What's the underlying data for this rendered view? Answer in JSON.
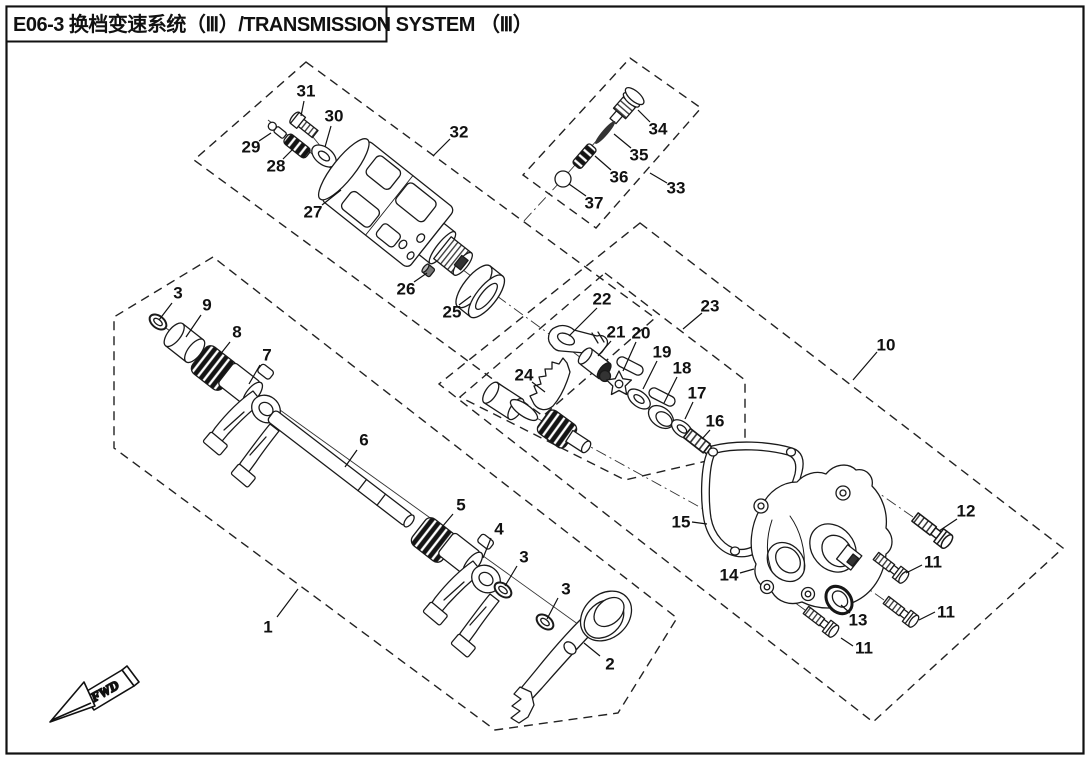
{
  "title": {
    "text": "E06-3 换档变速系统（Ⅲ）/TRANSMISSION SYSTEM （Ⅲ）"
  },
  "fwd": {
    "label": "FWD"
  },
  "colors": {
    "ink": "#1a1a1a",
    "paper": "#ffffff"
  },
  "groups": [
    {
      "id": "shift-fork-shaft-assembly",
      "label_num": "1",
      "points": "213,257 114,317 114,448 495,730 618,713 677,618"
    },
    {
      "id": "shift-drum-assembly",
      "label_num": "32",
      "points": "306,62 655,318 543,416 194,160"
    },
    {
      "id": "detent-assembly",
      "label_num": "33",
      "points": "630,58 701,108 596,228 523,175"
    },
    {
      "id": "shift-cam-assembly",
      "label_num": "23",
      "points": "605,273 745,380 745,452 625,480 460,397"
    },
    {
      "id": "cover-assembly",
      "label_num": "10",
      "points": "640,223 1063,548 873,722 439,384"
    }
  ],
  "centerlines": [
    {
      "x1": 152,
      "y1": 318,
      "x2": 600,
      "y2": 640,
      "style": "solid"
    },
    {
      "x1": 268,
      "y1": 120,
      "x2": 497,
      "y2": 296,
      "style": "solid"
    },
    {
      "x1": 303,
      "y1": 125,
      "x2": 322,
      "y2": 148,
      "style": "solid"
    },
    {
      "x1": 636,
      "y1": 96,
      "x2": 560,
      "y2": 182,
      "style": "solid"
    },
    {
      "x1": 552,
      "y1": 336,
      "x2": 726,
      "y2": 468,
      "style": "solid"
    },
    {
      "x1": 497,
      "y1": 397,
      "x2": 578,
      "y2": 440,
      "style": "solid"
    },
    {
      "x1": 497,
      "y1": 296,
      "x2": 556,
      "y2": 339,
      "style": "dashdot"
    },
    {
      "x1": 560,
      "y1": 182,
      "x2": 523,
      "y2": 222,
      "style": "dashdot"
    },
    {
      "x1": 578,
      "y1": 440,
      "x2": 716,
      "y2": 516,
      "style": "dashdot"
    },
    {
      "x1": 872,
      "y1": 556,
      "x2": 840,
      "y2": 532,
      "style": "dashdot"
    },
    {
      "x1": 884,
      "y1": 600,
      "x2": 850,
      "y2": 576,
      "style": "dashdot"
    },
    {
      "x1": 805,
      "y1": 610,
      "x2": 772,
      "y2": 586,
      "style": "dashdot"
    },
    {
      "x1": 913,
      "y1": 517,
      "x2": 880,
      "y2": 494,
      "style": "dashdot"
    }
  ],
  "part_labels": [
    {
      "num": "1",
      "x": 268,
      "y": 627,
      "leader": [
        277,
        617,
        298,
        589
      ]
    },
    {
      "num": "2",
      "x": 610,
      "y": 664,
      "leader": [
        600,
        656,
        584,
        643
      ]
    },
    {
      "num": "3",
      "x": 178,
      "y": 293,
      "leader": [
        172,
        303,
        159,
        320
      ]
    },
    {
      "num": "9",
      "x": 207,
      "y": 305,
      "leader": [
        201,
        315,
        186,
        337
      ]
    },
    {
      "num": "8",
      "x": 237,
      "y": 332,
      "leader": [
        230,
        342,
        215,
        361
      ]
    },
    {
      "num": "7",
      "x": 267,
      "y": 355,
      "leader": [
        260,
        365,
        249,
        384
      ]
    },
    {
      "num": "6",
      "x": 364,
      "y": 440,
      "leader": [
        357,
        450,
        345,
        467
      ]
    },
    {
      "num": "5",
      "x": 461,
      "y": 505,
      "leader": [
        453,
        514,
        442,
        527
      ]
    },
    {
      "num": "4",
      "x": 499,
      "y": 529,
      "leader": [
        491,
        538,
        483,
        558
      ]
    },
    {
      "num": "3",
      "x": 524,
      "y": 557,
      "leader": [
        517,
        566,
        505,
        586
      ]
    },
    {
      "num": "3",
      "x": 566,
      "y": 589,
      "leader": [
        558,
        598,
        547,
        619
      ]
    },
    {
      "num": "27",
      "x": 313,
      "y": 212,
      "leader": [
        322,
        205,
        341,
        190
      ]
    },
    {
      "num": "26",
      "x": 406,
      "y": 289,
      "leader": [
        414,
        282,
        427,
        273
      ]
    },
    {
      "num": "25",
      "x": 452,
      "y": 312,
      "leader": [
        459,
        305,
        471,
        296
      ]
    },
    {
      "num": "28",
      "x": 276,
      "y": 166,
      "leader": [
        283,
        159,
        293,
        149
      ]
    },
    {
      "num": "29",
      "x": 251,
      "y": 147,
      "leader": [
        259,
        141,
        271,
        133
      ]
    },
    {
      "num": "30",
      "x": 334,
      "y": 116,
      "leader": [
        331,
        126,
        325,
        147
      ]
    },
    {
      "num": "31",
      "x": 306,
      "y": 91,
      "leader": [
        304,
        101,
        301,
        116
      ]
    },
    {
      "num": "32",
      "x": 459,
      "y": 132,
      "leader": [
        450,
        139,
        433,
        156
      ]
    },
    {
      "num": "33",
      "x": 676,
      "y": 188,
      "leader": [
        667,
        183,
        650,
        173
      ]
    },
    {
      "num": "34",
      "x": 658,
      "y": 129,
      "leader": [
        650,
        122,
        638,
        110
      ]
    },
    {
      "num": "35",
      "x": 639,
      "y": 155,
      "leader": [
        631,
        148,
        614,
        134
      ]
    },
    {
      "num": "36",
      "x": 619,
      "y": 177,
      "leader": [
        611,
        170,
        595,
        156
      ]
    },
    {
      "num": "37",
      "x": 594,
      "y": 203,
      "leader": [
        586,
        196,
        569,
        184
      ]
    },
    {
      "num": "22",
      "x": 602,
      "y": 299,
      "leader": [
        597,
        308,
        569,
        336
      ]
    },
    {
      "num": "21",
      "x": 616,
      "y": 332,
      "leader": [
        611,
        341,
        598,
        356
      ]
    },
    {
      "num": "20",
      "x": 641,
      "y": 333,
      "leader": [
        636,
        342,
        623,
        371
      ]
    },
    {
      "num": "19",
      "x": 662,
      "y": 352,
      "leader": [
        657,
        361,
        643,
        389
      ]
    },
    {
      "num": "18",
      "x": 682,
      "y": 368,
      "leader": [
        677,
        377,
        664,
        403
      ]
    },
    {
      "num": "17",
      "x": 697,
      "y": 393,
      "leader": [
        693,
        402,
        685,
        419
      ]
    },
    {
      "num": "16",
      "x": 715,
      "y": 421,
      "leader": [
        710,
        430,
        702,
        439
      ]
    },
    {
      "num": "24",
      "x": 524,
      "y": 375,
      "leader": [
        532,
        382,
        545,
        392
      ]
    },
    {
      "num": "23",
      "x": 710,
      "y": 306,
      "leader": [
        702,
        313,
        683,
        329
      ]
    },
    {
      "num": "10",
      "x": 886,
      "y": 345,
      "leader": [
        877,
        352,
        853,
        380
      ]
    },
    {
      "num": "15",
      "x": 681,
      "y": 522,
      "leader": [
        692,
        522,
        707,
        524
      ]
    },
    {
      "num": "14",
      "x": 729,
      "y": 575,
      "leader": [
        740,
        573,
        754,
        569
      ]
    },
    {
      "num": "13",
      "x": 858,
      "y": 620,
      "leader": [
        850,
        613,
        841,
        605
      ]
    },
    {
      "num": "11",
      "x": 933,
      "y": 562,
      "leader": [
        922,
        565,
        906,
        573
      ]
    },
    {
      "num": "11",
      "x": 946,
      "y": 612,
      "leader": [
        935,
        612,
        919,
        620
      ]
    },
    {
      "num": "11",
      "x": 864,
      "y": 648,
      "leader": [
        853,
        646,
        841,
        638
      ]
    },
    {
      "num": "12",
      "x": 966,
      "y": 511,
      "leader": [
        957,
        519,
        939,
        531
      ]
    }
  ]
}
